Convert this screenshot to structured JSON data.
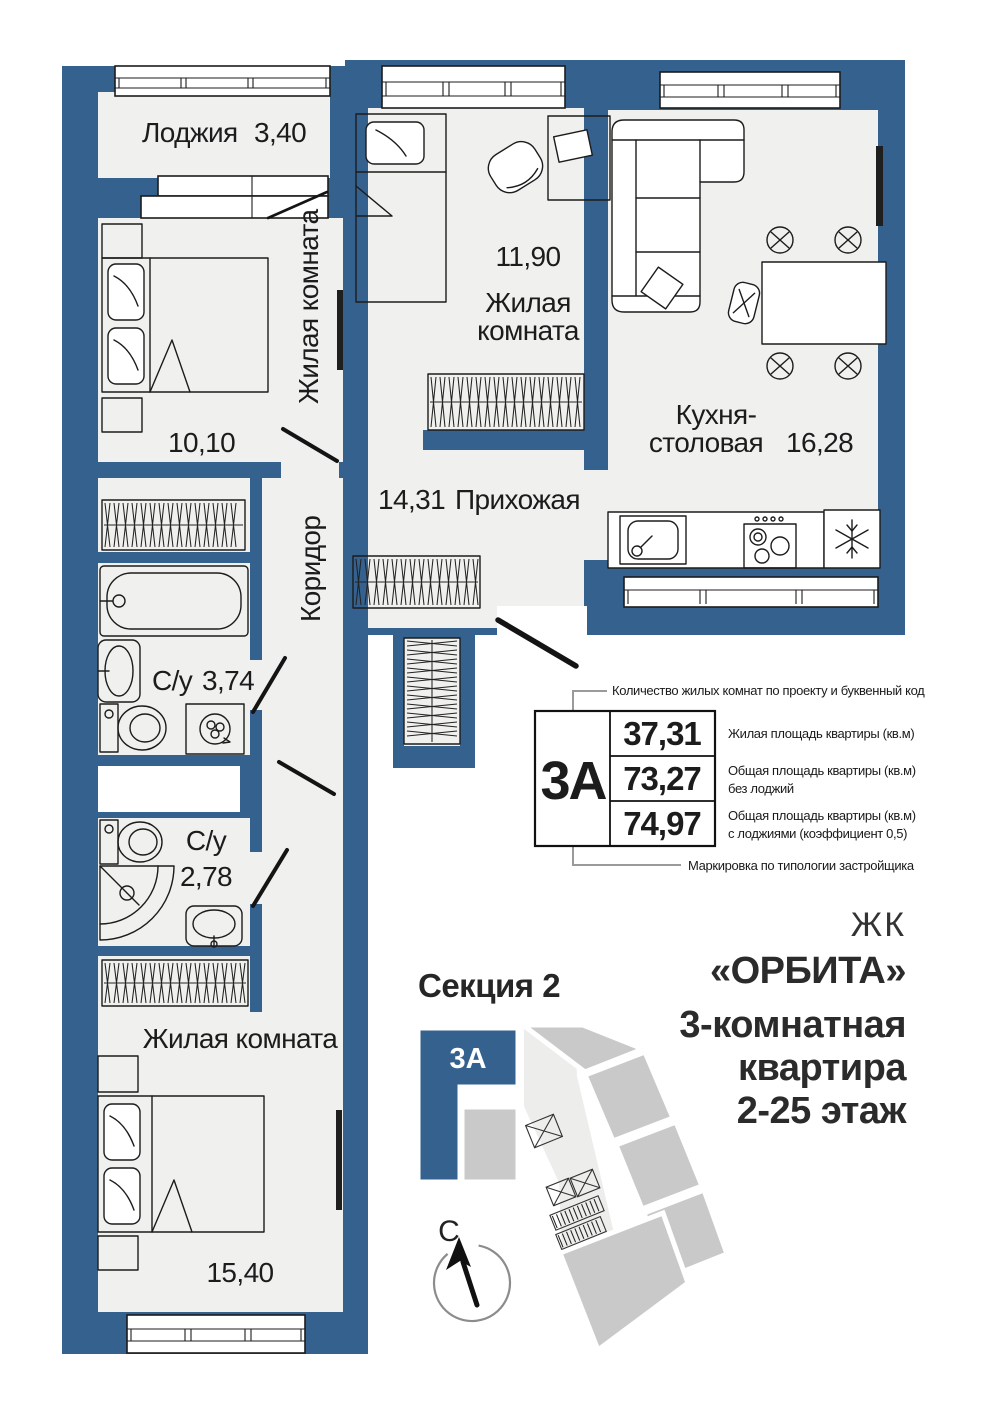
{
  "colors": {
    "wall": "#35618E",
    "floor": "#F0F0EE",
    "ink": "#1C1C1C",
    "map_gray": "#C9C9C9",
    "map_core": "#EDEDEB",
    "callout": "#9A9A9A",
    "title": "#2B2B2B"
  },
  "rooms": {
    "loggia": {
      "name": "Лоджия",
      "area": "3,40"
    },
    "bedroom_left": {
      "name": "Жилая комната",
      "area": "10,10"
    },
    "bedroom_top": {
      "name_line1": "Жилая",
      "name_line2": "комната",
      "area": "11,90"
    },
    "kitchen": {
      "name_line1": "Кухня-",
      "name_line2": "столовая",
      "area": "16,28"
    },
    "hallway": {
      "name": "Прихожая",
      "area": "14,31"
    },
    "corridor": {
      "name": "Коридор"
    },
    "bath_main": {
      "name": "С/у",
      "area": "3,74"
    },
    "bath_guest": {
      "name": "С/у",
      "area": "2,78"
    },
    "bedroom_bottom": {
      "name": "Жилая комната",
      "area": "15,40"
    }
  },
  "spec": {
    "code": "3А",
    "rows": [
      {
        "value": "37,31",
        "note_lines": [
          "Жилая площадь квартиры (кв.м)"
        ]
      },
      {
        "value": "73,27",
        "note_lines": [
          "Общая площадь квартиры (кв.м)",
          "без лоджий"
        ]
      },
      {
        "value": "74,97",
        "note_lines": [
          "Общая площадь квартиры (кв.м)",
          "с лоджиями (коэффициент 0,5)"
        ]
      }
    ],
    "top_note": "Количество жилых комнат по проекту и буквенный код",
    "bottom_note": "Маркировка по типологии застройщика"
  },
  "section": {
    "title": "Секция 2",
    "unit_code": "3А"
  },
  "compass": {
    "north_label": "С"
  },
  "project": {
    "prefix": "ЖК",
    "name": "«ОРБИТА»",
    "apartment_line1": "3-комнатная",
    "apartment_line2": "квартира",
    "floors": "2-25 этаж"
  }
}
